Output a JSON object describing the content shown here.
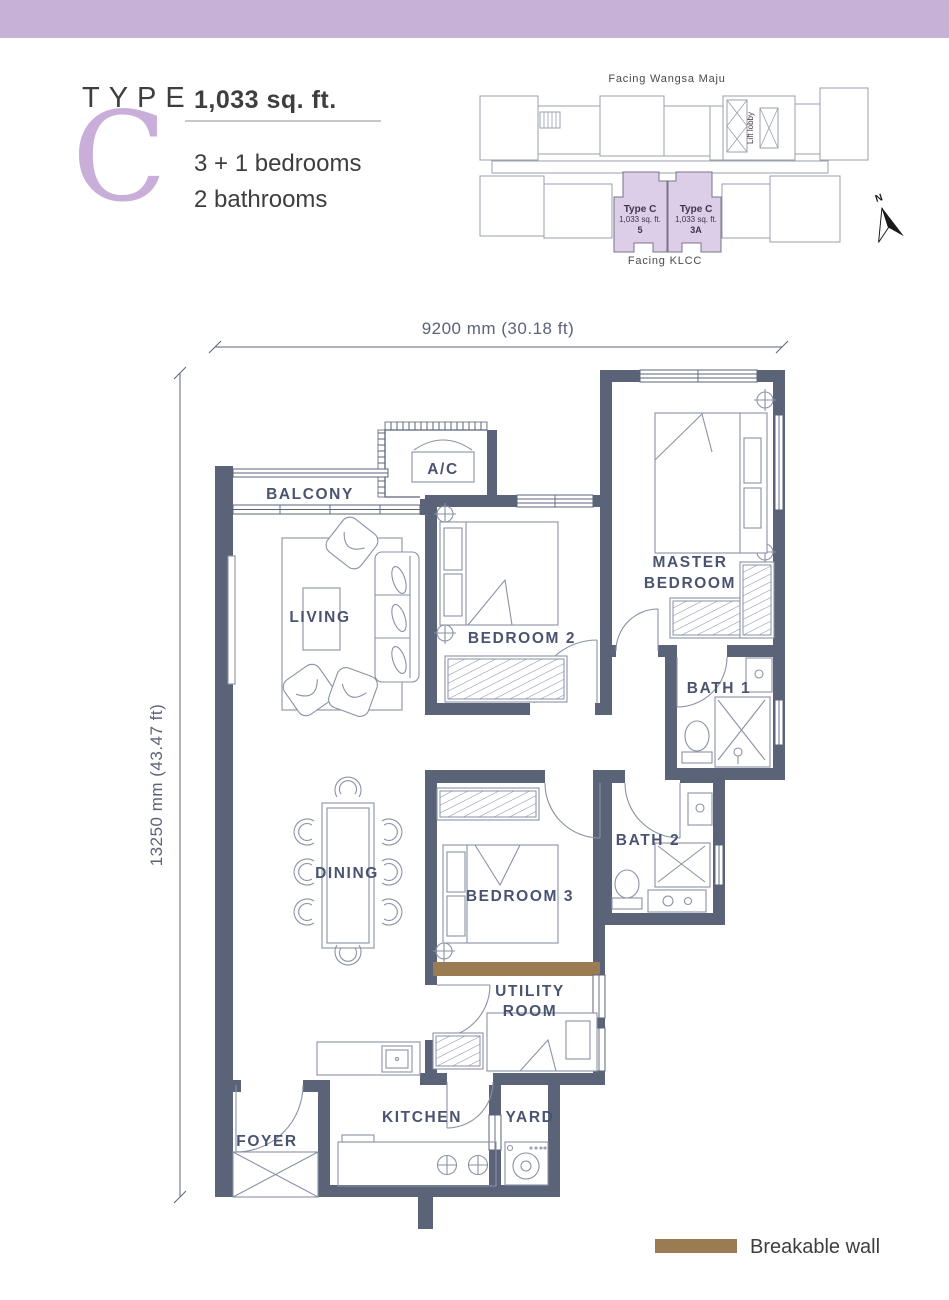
{
  "header": {
    "type_label": "TYPE",
    "type_letter": "C",
    "area": "1,033 sq. ft.",
    "bedrooms": "3 + 1 bedrooms",
    "bathrooms": "2 bathrooms"
  },
  "keyplan": {
    "facing_top": "Facing Wangsa Maju",
    "facing_bottom": "Facing KLCC",
    "lift_lobby": "Lift lobby",
    "north_label": "N",
    "units": [
      {
        "name": "Type C",
        "area": "1,033 sq. ft.",
        "unit_no": "5"
      },
      {
        "name": "Type C",
        "area": "1,033 sq. ft.",
        "unit_no": "3A"
      }
    ]
  },
  "dimensions": {
    "width": "9200 mm (30.18 ft)",
    "height": "13250 mm (43.47 ft)"
  },
  "rooms": {
    "balcony": "BALCONY",
    "ac": "A/C",
    "living": "LIVING",
    "bedroom2": "BEDROOM 2",
    "master_line1": "MASTER",
    "master_line2": "BEDROOM",
    "bath1": "BATH 1",
    "dining": "DINING",
    "bedroom3": "BEDROOM 3",
    "bath2": "BATH 2",
    "utility_line1": "UTILITY",
    "utility_line2": "ROOM",
    "kitchen": "KITCHEN",
    "yard": "YARD",
    "foyer": "FOYER"
  },
  "legend": {
    "breakable_wall": "Breakable wall"
  },
  "colors": {
    "accent_lavender": "#C7B1D6",
    "unit_highlight": "#DCCDE8",
    "wall": "#5A6378",
    "breakable_wall": "#9B7B52",
    "letter_purple": "#C8AED9"
  }
}
